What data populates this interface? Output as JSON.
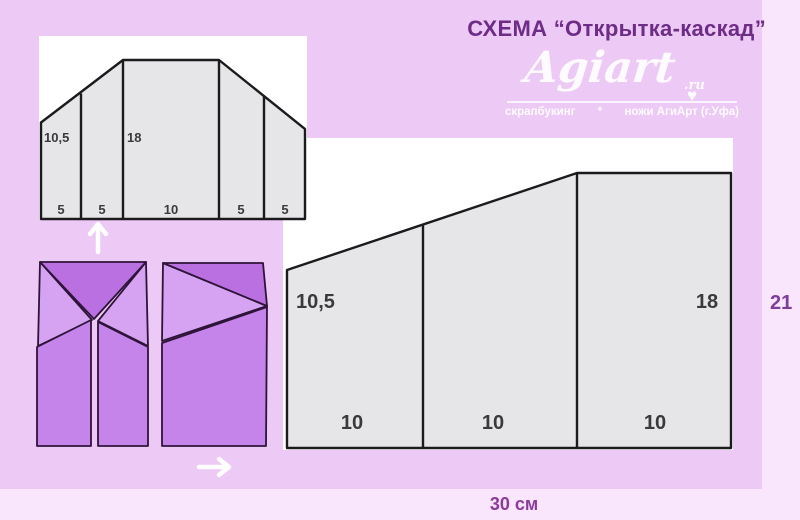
{
  "page": {
    "title": "СХЕМА “Открытка-каскад”",
    "total_width_label": "30 см",
    "total_height_label": "21"
  },
  "logo": {
    "name": "Agiart",
    "domain": ".ru",
    "heart": "♥",
    "tagline_left": "скрапбукинг",
    "tagline_separator": "*",
    "tagline_right": "ножи АгиАрт (г.Уфа)"
  },
  "diagram_unfolded": {
    "description": "small scoring diagram of unfolded cascade card",
    "height_left_label": "10,5",
    "height_middle_label": "18",
    "bottom_segments": [
      "5",
      "5",
      "10",
      "5",
      "5"
    ]
  },
  "diagram_panels": {
    "description": "large scoring diagram 30 cm wide sheet",
    "height_left_label": "10,5",
    "height_right_label": "18",
    "bottom_segments": [
      "10",
      "10",
      "10"
    ]
  },
  "colors": {
    "background_outer": "#F9E6FD",
    "background_panel": "#EDC9F6",
    "card_fill": "#E6E5E7",
    "card_stroke": "#1B1B1D",
    "fold_dark": "#BB70E2",
    "fold_light": "#D6A3F2",
    "fold_mid": "#C584E9",
    "title_purple": "#6D2C86",
    "dimension_purple": "#8C3A9C"
  }
}
